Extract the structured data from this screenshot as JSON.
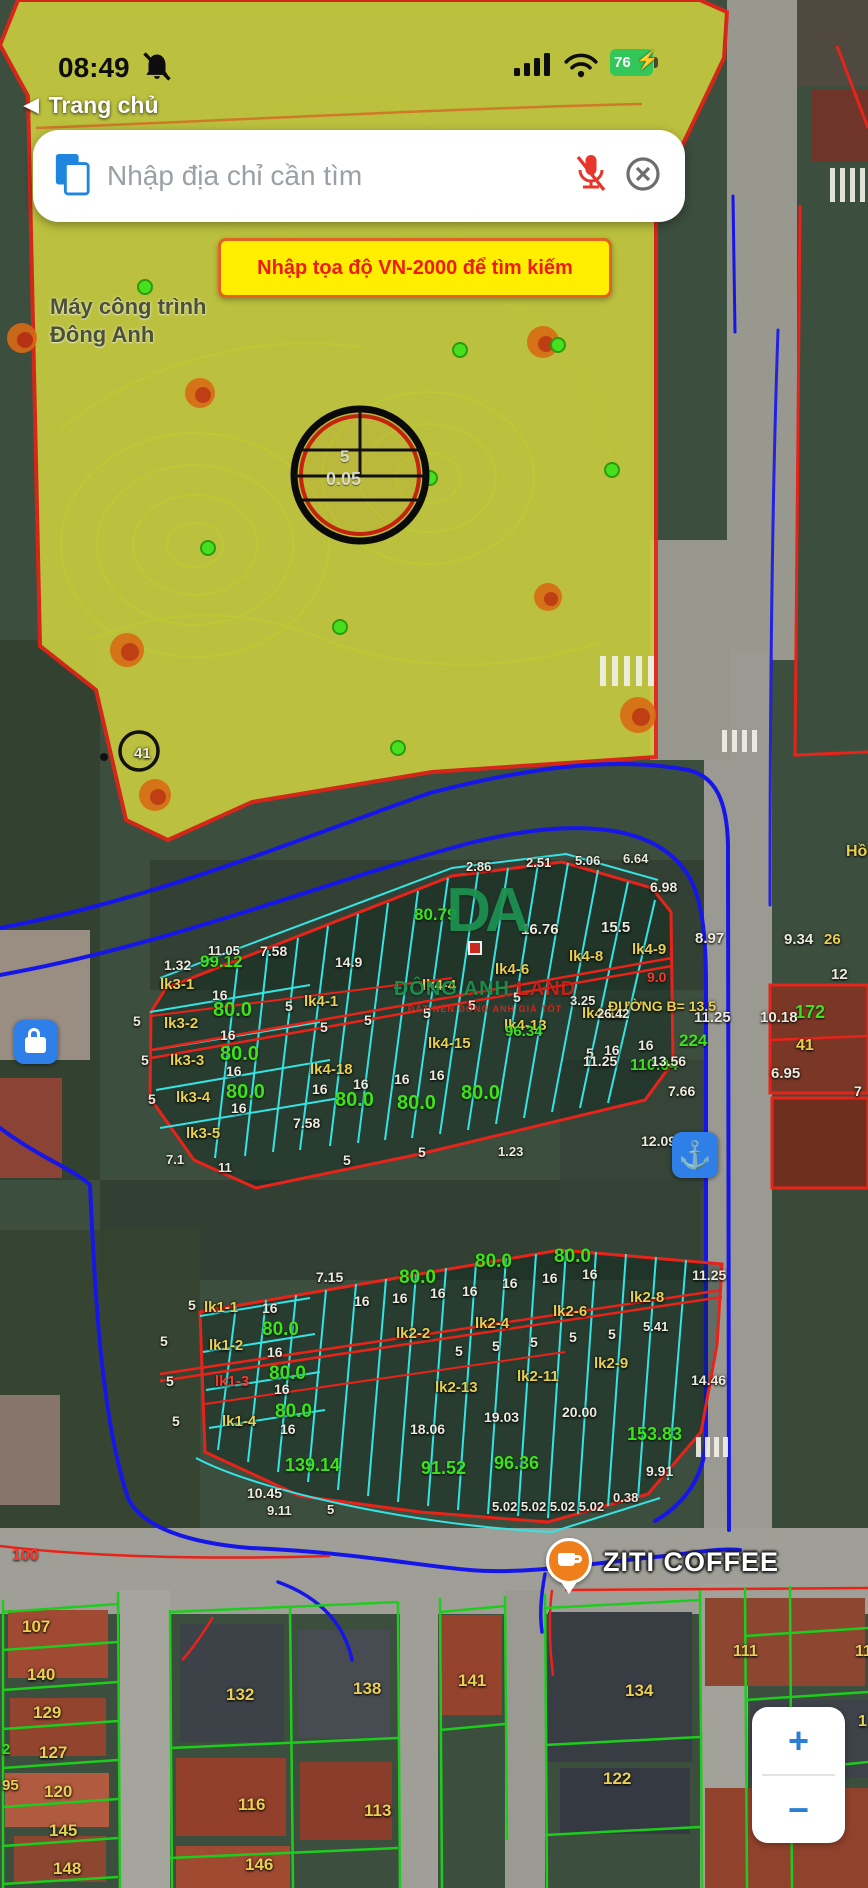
{
  "status_bar": {
    "time": "08:49",
    "battery_percent": "76"
  },
  "nav": {
    "back_label": "Trang chủ"
  },
  "search": {
    "placeholder": "Nhập địa chỉ cần tìm"
  },
  "banner": {
    "text": "Nhập tọa độ VN-2000 để tìm kiếm"
  },
  "toolbar": {
    "do_kt": "ĐO KT",
    "do_dt": "ĐO DT",
    "xoa": "Xóa",
    "tim": "Tìm"
  },
  "map_controls": {
    "zoom_in": "+",
    "zoom_out": "−"
  },
  "watermark": {
    "logo": "DA",
    "line1": "ĐÔNG ANH",
    "line2": "LAND",
    "subtext": "ĐẤT NỀN ĐÔNG ANH GIÁ TỐT"
  },
  "icons": {
    "status": [
      "bell-muted-icon",
      "signal-bars-icon",
      "wifi-icon",
      "battery-icon"
    ],
    "search": [
      "paste-icon",
      "mic-muted-icon",
      "clear-icon"
    ],
    "tools": [
      "layers-icon",
      "tape-measure-icon",
      "area-m2-icon",
      "trash-icon",
      "search-icon"
    ],
    "map": [
      "crosshair-locate-icon",
      "coffee-pin-icon",
      "lock-poi-icon",
      "anchor-poi-icon"
    ]
  },
  "colors": {
    "accent_blue": "#2a7fd4",
    "banner_yellow": "#ffee00",
    "banner_red": "#ee1c10",
    "parcel_cyan": "#35e3e3",
    "parcel_red": "#e8231a",
    "parcel_green_line": "#1ecc1e",
    "zone_yellow": "#c9cd3f",
    "label_yellow": "#e9cf52",
    "label_green": "#3de318"
  },
  "map": {
    "labels": [
      {
        "t": "Máy công trình",
        "x": 50,
        "y": 296,
        "c": "d",
        "s": 22
      },
      {
        "t": "Đông Anh",
        "x": 50,
        "y": 324,
        "c": "d",
        "s": 22
      },
      {
        "t": "41",
        "x": 134,
        "y": 746,
        "c": "w",
        "s": 15
      },
      {
        "t": "5",
        "x": 340,
        "y": 448,
        "c": "cc",
        "s": 17
      },
      {
        "t": "0.05",
        "x": 326,
        "y": 470,
        "c": "cc",
        "s": 18
      },
      {
        "t": "Hồ",
        "x": 846,
        "y": 844,
        "c": "y",
        "s": 16
      },
      {
        "t": "1.32",
        "x": 164,
        "y": 958,
        "c": "w",
        "s": 14
      },
      {
        "t": "99.12",
        "x": 200,
        "y": 953,
        "c": "g",
        "s": 17
      },
      {
        "t": "11.05",
        "x": 208,
        "y": 944,
        "c": "w",
        "s": 13
      },
      {
        "t": "7.58",
        "x": 260,
        "y": 944,
        "c": "w",
        "s": 14
      },
      {
        "t": "14.9",
        "x": 335,
        "y": 955,
        "c": "w",
        "s": 14
      },
      {
        "t": "lk3-1",
        "x": 160,
        "y": 977,
        "c": "y",
        "s": 15
      },
      {
        "t": "16",
        "x": 212,
        "y": 988,
        "c": "w",
        "s": 14
      },
      {
        "t": "80.0",
        "x": 213,
        "y": 1000,
        "c": "g",
        "s": 20
      },
      {
        "t": "lk3-2",
        "x": 164,
        "y": 1016,
        "c": "y",
        "s": 15
      },
      {
        "t": "16",
        "x": 220,
        "y": 1028,
        "c": "w",
        "s": 14
      },
      {
        "t": "80.0",
        "x": 220,
        "y": 1044,
        "c": "g",
        "s": 20
      },
      {
        "t": "lk3-3",
        "x": 170,
        "y": 1053,
        "c": "y",
        "s": 15
      },
      {
        "t": "16",
        "x": 226,
        "y": 1064,
        "c": "w",
        "s": 14
      },
      {
        "t": "80.0",
        "x": 226,
        "y": 1082,
        "c": "g",
        "s": 20
      },
      {
        "t": "lk3-4",
        "x": 176,
        "y": 1090,
        "c": "y",
        "s": 15
      },
      {
        "t": "16",
        "x": 231,
        "y": 1101,
        "c": "w",
        "s": 14
      },
      {
        "t": "lk3-5",
        "x": 186,
        "y": 1126,
        "c": "y",
        "s": 15
      },
      {
        "t": "7.58",
        "x": 293,
        "y": 1116,
        "c": "w",
        "s": 14
      },
      {
        "t": "5",
        "x": 133,
        "y": 1014,
        "c": "w",
        "s": 14
      },
      {
        "t": "5",
        "x": 141,
        "y": 1053,
        "c": "w",
        "s": 14
      },
      {
        "t": "5",
        "x": 148,
        "y": 1092,
        "c": "w",
        "s": 14
      },
      {
        "t": "7.1",
        "x": 166,
        "y": 1153,
        "c": "w",
        "s": 13
      },
      {
        "t": "11",
        "x": 218,
        "y": 1161,
        "c": "w",
        "s": 13
      },
      {
        "t": "lk4-1",
        "x": 304,
        "y": 994,
        "c": "y",
        "s": 15
      },
      {
        "t": "lk4-18",
        "x": 310,
        "y": 1062,
        "c": "y",
        "s": 15
      },
      {
        "t": "16",
        "x": 312,
        "y": 1082,
        "c": "w",
        "s": 14
      },
      {
        "t": "16",
        "x": 353,
        "y": 1077,
        "c": "w",
        "s": 14
      },
      {
        "t": "16",
        "x": 394,
        "y": 1072,
        "c": "w",
        "s": 14
      },
      {
        "t": "16",
        "x": 429,
        "y": 1068,
        "c": "w",
        "s": 14
      },
      {
        "t": "80.0",
        "x": 335,
        "y": 1090,
        "c": "g",
        "s": 20
      },
      {
        "t": "80.0",
        "x": 397,
        "y": 1093,
        "c": "g",
        "s": 20
      },
      {
        "t": "80.0",
        "x": 461,
        "y": 1083,
        "c": "g",
        "s": 20
      },
      {
        "t": "5",
        "x": 285,
        "y": 999,
        "c": "w",
        "s": 14
      },
      {
        "t": "5",
        "x": 320,
        "y": 1020,
        "c": "w",
        "s": 14
      },
      {
        "t": "5",
        "x": 364,
        "y": 1013,
        "c": "w",
        "s": 14
      },
      {
        "t": "5",
        "x": 423,
        "y": 1006,
        "c": "w",
        "s": 14
      },
      {
        "t": "5",
        "x": 468,
        "y": 998,
        "c": "w",
        "s": 14
      },
      {
        "t": "5",
        "x": 513,
        "y": 990,
        "c": "w",
        "s": 14
      },
      {
        "t": "2.86",
        "x": 466,
        "y": 860,
        "c": "w",
        "s": 13
      },
      {
        "t": "2.51",
        "x": 526,
        "y": 856,
        "c": "w",
        "s": 13
      },
      {
        "t": "5.06",
        "x": 575,
        "y": 854,
        "c": "w",
        "s": 13
      },
      {
        "t": "6.64",
        "x": 623,
        "y": 852,
        "c": "w",
        "s": 13
      },
      {
        "t": "6.98",
        "x": 650,
        "y": 880,
        "c": "w",
        "s": 14
      },
      {
        "t": "16.76",
        "x": 521,
        "y": 922,
        "c": "w",
        "s": 15
      },
      {
        "t": "15.5",
        "x": 601,
        "y": 920,
        "c": "w",
        "s": 15
      },
      {
        "t": "80.79",
        "x": 414,
        "y": 906,
        "c": "g",
        "s": 17
      },
      {
        "t": "lk4-4",
        "x": 422,
        "y": 978,
        "c": "y",
        "s": 15
      },
      {
        "t": "lk4-6",
        "x": 495,
        "y": 962,
        "c": "y",
        "s": 15
      },
      {
        "t": "lk4-8",
        "x": 569,
        "y": 949,
        "c": "y",
        "s": 15
      },
      {
        "t": "lk4-9",
        "x": 632,
        "y": 942,
        "c": "y",
        "s": 15
      },
      {
        "t": "9.0",
        "x": 647,
        "y": 970,
        "c": "r",
        "s": 14
      },
      {
        "t": "lk4-11",
        "x": 582,
        "y": 1006,
        "c": "y",
        "s": 15
      },
      {
        "t": "lk4-13",
        "x": 504,
        "y": 1018,
        "c": "y",
        "s": 15
      },
      {
        "t": "lk4-15",
        "x": 428,
        "y": 1036,
        "c": "y",
        "s": 15
      },
      {
        "t": "16",
        "x": 604,
        "y": 1043,
        "c": "w",
        "s": 14
      },
      {
        "t": "16",
        "x": 638,
        "y": 1038,
        "c": "w",
        "s": 14
      },
      {
        "t": "5",
        "x": 586,
        "y": 1046,
        "c": "w",
        "s": 14
      },
      {
        "t": "110.04",
        "x": 630,
        "y": 1058,
        "c": "g",
        "s": 16
      },
      {
        "t": "7.66",
        "x": 668,
        "y": 1084,
        "c": "w",
        "s": 14
      },
      {
        "t": "5",
        "x": 343,
        "y": 1153,
        "c": "w",
        "s": 14
      },
      {
        "t": "5",
        "x": 418,
        "y": 1145,
        "c": "w",
        "s": 14
      },
      {
        "t": "1.23",
        "x": 498,
        "y": 1145,
        "c": "w",
        "s": 13
      },
      {
        "t": "8.97",
        "x": 695,
        "y": 931,
        "c": "w",
        "s": 15
      },
      {
        "t": "11.25",
        "x": 694,
        "y": 1010,
        "c": "w",
        "s": 15
      },
      {
        "t": "9.34",
        "x": 784,
        "y": 932,
        "c": "w",
        "s": 15
      },
      {
        "t": "26",
        "x": 824,
        "y": 932,
        "c": "y",
        "s": 15
      },
      {
        "t": "12",
        "x": 831,
        "y": 967,
        "c": "w",
        "s": 15
      },
      {
        "t": "172",
        "x": 795,
        "y": 1003,
        "c": "g",
        "s": 18
      },
      {
        "t": "10.18",
        "x": 760,
        "y": 1010,
        "c": "w",
        "s": 15
      },
      {
        "t": "41",
        "x": 796,
        "y": 1038,
        "c": "y",
        "s": 16
      },
      {
        "t": "6.95",
        "x": 771,
        "y": 1066,
        "c": "w",
        "s": 15
      },
      {
        "t": "7",
        "x": 854,
        "y": 1084,
        "c": "w",
        "s": 14
      },
      {
        "t": "ĐƯỜNG B= 13.5",
        "x": 608,
        "y": 999,
        "c": "y",
        "s": 14
      },
      {
        "t": "3.25",
        "x": 570,
        "y": 994,
        "c": "w",
        "s": 13
      },
      {
        "t": "26.42",
        "x": 597,
        "y": 1007,
        "c": "w",
        "s": 13
      },
      {
        "t": "96.34",
        "x": 505,
        "y": 1024,
        "c": "g",
        "s": 15
      },
      {
        "t": "11.25",
        "x": 583,
        "y": 1054,
        "c": "w",
        "s": 14
      },
      {
        "t": "13.56",
        "x": 651,
        "y": 1054,
        "c": "w",
        "s": 14
      },
      {
        "t": "224",
        "x": 679,
        "y": 1032,
        "c": "g",
        "s": 17
      },
      {
        "t": "12.09",
        "x": 641,
        "y": 1134,
        "c": "w",
        "s": 14
      },
      {
        "t": "67",
        "x": 680,
        "y": 1160,
        "c": "g",
        "s": 17
      },
      {
        "t": "11.25",
        "x": 692,
        "y": 1268,
        "c": "w",
        "s": 14
      },
      {
        "t": "14.46",
        "x": 691,
        "y": 1373,
        "c": "w",
        "s": 14
      },
      {
        "t": "7.15",
        "x": 316,
        "y": 1270,
        "c": "w",
        "s": 14
      },
      {
        "t": "80.0",
        "x": 399,
        "y": 1268,
        "c": "g",
        "s": 19
      },
      {
        "t": "80.0",
        "x": 475,
        "y": 1252,
        "c": "g",
        "s": 19
      },
      {
        "t": "80.0",
        "x": 554,
        "y": 1247,
        "c": "g",
        "s": 19
      },
      {
        "t": "16",
        "x": 262,
        "y": 1301,
        "c": "w",
        "s": 14
      },
      {
        "t": "16",
        "x": 354,
        "y": 1294,
        "c": "w",
        "s": 14
      },
      {
        "t": "16",
        "x": 392,
        "y": 1291,
        "c": "w",
        "s": 14
      },
      {
        "t": "16",
        "x": 430,
        "y": 1286,
        "c": "w",
        "s": 14
      },
      {
        "t": "16",
        "x": 462,
        "y": 1284,
        "c": "w",
        "s": 14
      },
      {
        "t": "16",
        "x": 502,
        "y": 1276,
        "c": "w",
        "s": 14
      },
      {
        "t": "16",
        "x": 542,
        "y": 1271,
        "c": "w",
        "s": 14
      },
      {
        "t": "16",
        "x": 582,
        "y": 1267,
        "c": "w",
        "s": 14
      },
      {
        "t": "lk1-1",
        "x": 204,
        "y": 1300,
        "c": "y",
        "s": 15
      },
      {
        "t": "80.0",
        "x": 262,
        "y": 1320,
        "c": "g",
        "s": 19
      },
      {
        "t": "lk1-2",
        "x": 209,
        "y": 1338,
        "c": "y",
        "s": 15
      },
      {
        "t": "16",
        "x": 267,
        "y": 1345,
        "c": "w",
        "s": 14
      },
      {
        "t": "lk1-3",
        "x": 215,
        "y": 1374,
        "c": "r",
        "s": 15
      },
      {
        "t": "80.0",
        "x": 269,
        "y": 1364,
        "c": "g",
        "s": 19
      },
      {
        "t": "16",
        "x": 274,
        "y": 1382,
        "c": "w",
        "s": 14
      },
      {
        "t": "lk1-4",
        "x": 222,
        "y": 1414,
        "c": "y",
        "s": 15
      },
      {
        "t": "80.0",
        "x": 275,
        "y": 1402,
        "c": "g",
        "s": 19
      },
      {
        "t": "16",
        "x": 280,
        "y": 1422,
        "c": "w",
        "s": 14
      },
      {
        "t": "139.14",
        "x": 285,
        "y": 1456,
        "c": "g",
        "s": 18
      },
      {
        "t": "10.45",
        "x": 247,
        "y": 1486,
        "c": "w",
        "s": 14
      },
      {
        "t": "5",
        "x": 160,
        "y": 1334,
        "c": "w",
        "s": 14
      },
      {
        "t": "5",
        "x": 166,
        "y": 1374,
        "c": "w",
        "s": 14
      },
      {
        "t": "5",
        "x": 172,
        "y": 1414,
        "c": "w",
        "s": 14
      },
      {
        "t": "5",
        "x": 188,
        "y": 1298,
        "c": "w",
        "s": 14
      },
      {
        "t": "lk2-2",
        "x": 396,
        "y": 1326,
        "c": "y",
        "s": 15
      },
      {
        "t": "lk2-4",
        "x": 475,
        "y": 1316,
        "c": "y",
        "s": 15
      },
      {
        "t": "lk2-6",
        "x": 553,
        "y": 1304,
        "c": "y",
        "s": 15
      },
      {
        "t": "lk2-8",
        "x": 630,
        "y": 1290,
        "c": "y",
        "s": 15
      },
      {
        "t": "5",
        "x": 455,
        "y": 1344,
        "c": "w",
        "s": 14
      },
      {
        "t": "5",
        "x": 492,
        "y": 1339,
        "c": "w",
        "s": 14
      },
      {
        "t": "5",
        "x": 530,
        "y": 1335,
        "c": "w",
        "s": 14
      },
      {
        "t": "5",
        "x": 569,
        "y": 1330,
        "c": "w",
        "s": 14
      },
      {
        "t": "5",
        "x": 608,
        "y": 1327,
        "c": "w",
        "s": 14
      },
      {
        "t": "5.41",
        "x": 643,
        "y": 1320,
        "c": "w",
        "s": 13
      },
      {
        "t": "lk2-13",
        "x": 435,
        "y": 1380,
        "c": "y",
        "s": 15
      },
      {
        "t": "lk2-11",
        "x": 517,
        "y": 1369,
        "c": "y",
        "s": 15
      },
      {
        "t": "lk2-9",
        "x": 594,
        "y": 1356,
        "c": "y",
        "s": 15
      },
      {
        "t": "18.06",
        "x": 410,
        "y": 1422,
        "c": "w",
        "s": 14
      },
      {
        "t": "19.03",
        "x": 484,
        "y": 1410,
        "c": "w",
        "s": 14
      },
      {
        "t": "20.00",
        "x": 562,
        "y": 1405,
        "c": "w",
        "s": 14
      },
      {
        "t": "91.52",
        "x": 421,
        "y": 1459,
        "c": "g",
        "s": 18
      },
      {
        "t": "96.36",
        "x": 494,
        "y": 1454,
        "c": "g",
        "s": 18
      },
      {
        "t": "153.83",
        "x": 627,
        "y": 1425,
        "c": "g",
        "s": 18
      },
      {
        "t": "9.91",
        "x": 646,
        "y": 1464,
        "c": "w",
        "s": 14
      },
      {
        "t": "0.38",
        "x": 613,
        "y": 1491,
        "c": "w",
        "s": 13
      },
      {
        "t": "9.11",
        "x": 267,
        "y": 1504,
        "c": "w",
        "s": 13
      },
      {
        "t": "5",
        "x": 327,
        "y": 1503,
        "c": "w",
        "s": 13
      },
      {
        "t": "5.02 5.02 5.02 5.02",
        "x": 492,
        "y": 1500,
        "c": "w",
        "s": 13
      },
      {
        "t": "2",
        "x": 2,
        "y": 1742,
        "c": "g",
        "s": 15
      },
      {
        "t": "95",
        "x": 2,
        "y": 1778,
        "c": "y",
        "s": 15
      },
      {
        "t": "ZITI COFFEE",
        "x": 603,
        "y": 1549,
        "c": "zt",
        "s": 27
      },
      {
        "t": "100",
        "x": 12,
        "y": 1548,
        "c": "r",
        "s": 16
      },
      {
        "t": "107",
        "x": 22,
        "y": 1618,
        "c": "y",
        "s": 17
      },
      {
        "t": "140",
        "x": 27,
        "y": 1666,
        "c": "y",
        "s": 17
      },
      {
        "t": "129",
        "x": 33,
        "y": 1704,
        "c": "y",
        "s": 17
      },
      {
        "t": "127",
        "x": 39,
        "y": 1744,
        "c": "y",
        "s": 17
      },
      {
        "t": "120",
        "x": 44,
        "y": 1783,
        "c": "y",
        "s": 17
      },
      {
        "t": "145",
        "x": 49,
        "y": 1822,
        "c": "y",
        "s": 17
      },
      {
        "t": "148",
        "x": 53,
        "y": 1860,
        "c": "y",
        "s": 17
      },
      {
        "t": "132",
        "x": 226,
        "y": 1686,
        "c": "y",
        "s": 17
      },
      {
        "t": "138",
        "x": 353,
        "y": 1680,
        "c": "y",
        "s": 17
      },
      {
        "t": "141",
        "x": 458,
        "y": 1672,
        "c": "y",
        "s": 17
      },
      {
        "t": "134",
        "x": 625,
        "y": 1682,
        "c": "y",
        "s": 17
      },
      {
        "t": "122",
        "x": 603,
        "y": 1770,
        "c": "y",
        "s": 17
      },
      {
        "t": "116",
        "x": 238,
        "y": 1796,
        "c": "y",
        "s": 17
      },
      {
        "t": "113",
        "x": 364,
        "y": 1802,
        "c": "y",
        "s": 17
      },
      {
        "t": "146",
        "x": 245,
        "y": 1856,
        "c": "y",
        "s": 17
      },
      {
        "t": "111",
        "x": 733,
        "y": 1644,
        "c": "y",
        "s": 16
      },
      {
        "t": "11",
        "x": 855,
        "y": 1644,
        "c": "y",
        "s": 16
      },
      {
        "t": "1",
        "x": 858,
        "y": 1714,
        "c": "y",
        "s": 16
      }
    ]
  }
}
